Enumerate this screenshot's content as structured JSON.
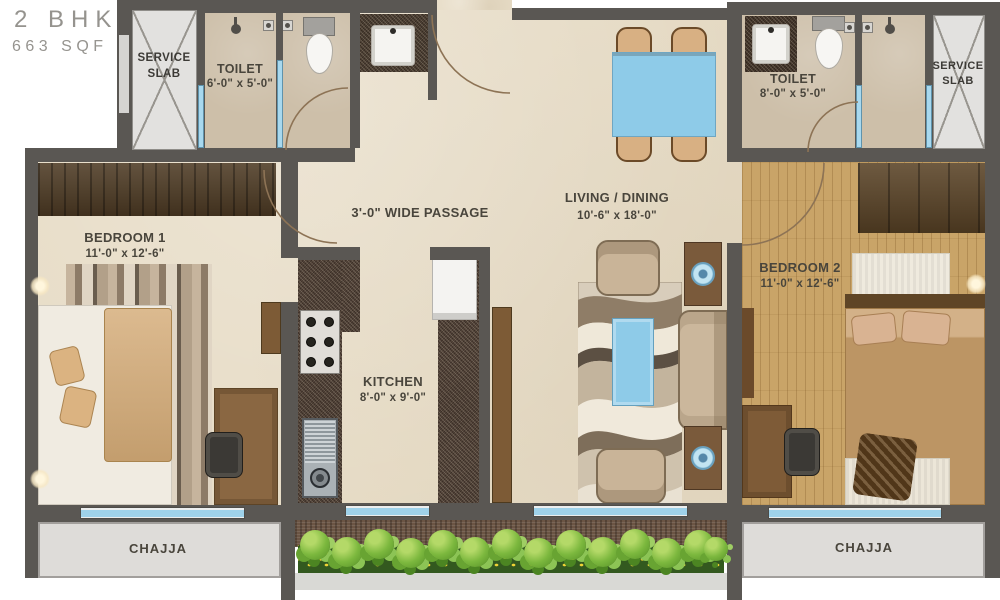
{
  "title": {
    "line1": "2 BHK",
    "line2": "663 SQF"
  },
  "rooms": {
    "service_slab_left": {
      "label": "SERVICE",
      "label2": "SLAB"
    },
    "service_slab_right": {
      "label": "SERVICE",
      "label2": "SLAB"
    },
    "toilet_1": {
      "label": "TOILET",
      "dims": "6'-0\" x 5'-0\""
    },
    "toilet_2": {
      "label": "TOILET",
      "dims": "8'-0\" x 5'-0\""
    },
    "bedroom_1": {
      "label": "BEDROOM 1",
      "dims": "11'-0\" x 12'-6\""
    },
    "bedroom_2": {
      "label": "BEDROOM 2",
      "dims": "11'-0\" x 12'-6\""
    },
    "kitchen": {
      "label": "KITCHEN",
      "dims": "8'-0\" x 9'-0\""
    },
    "living_dining": {
      "label": "LIVING / DINING",
      "dims": "10'-6\" x 18'-0\""
    },
    "passage": {
      "label": "3'-0\" WIDE PASSAGE"
    },
    "chajja_left": {
      "label": "CHAJJA"
    },
    "chajja_right": {
      "label": "CHAJJA"
    }
  },
  "colors": {
    "wall": "#5a5753",
    "floor": "#e7dcc6",
    "toilet_floor": "#cdbfa9",
    "wood_floor": "#c9a468",
    "accent_blue": "#8ecbe8",
    "window_blue": "#9fd2ea",
    "granite": "#55453a",
    "greenery": "#7cb83e",
    "chajja": "#dedcd9"
  }
}
